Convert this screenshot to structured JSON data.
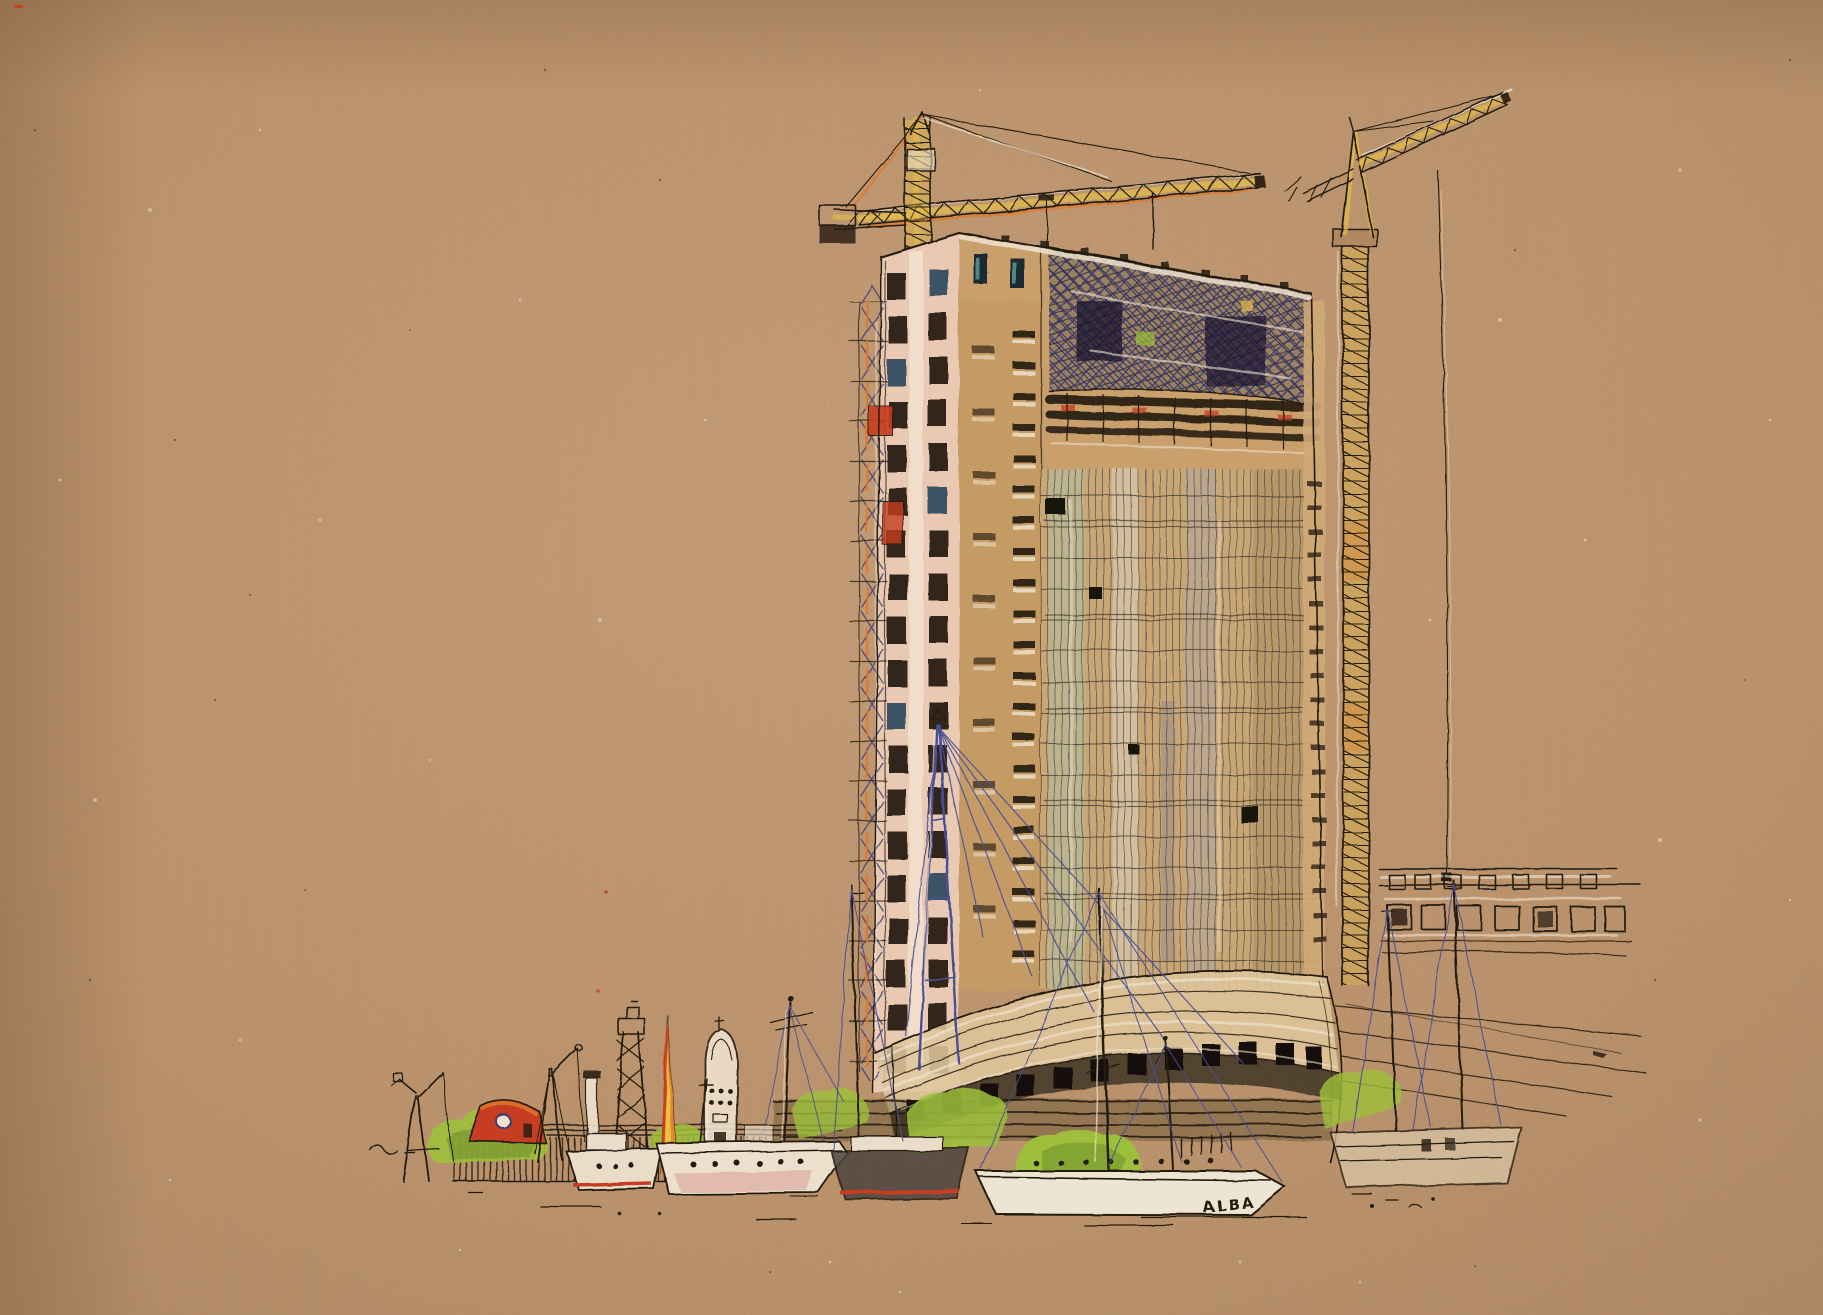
{
  "artwork": {
    "boat_name": "ALBA",
    "colors": {
      "paper": "#c5966a",
      "paper_light": "#d2a57a",
      "paper_dark": "#a87c52",
      "ink": "#241b10",
      "crane_yellow": "#e5be46",
      "crane_orange": "#dd7a2d",
      "accent_red": "#c63d20",
      "blue_pencil": "#4a4f96",
      "violet_crosshatch": "#3f3c72",
      "teal_glass": "#9fd4c0",
      "concrete_pink": "#e9c9b2",
      "concrete_tan": "#c9a06b",
      "gouache_white": "#efe3cf",
      "foliage_green": "#9ebf3a",
      "foliage_dark": "#6f8f2e"
    }
  }
}
